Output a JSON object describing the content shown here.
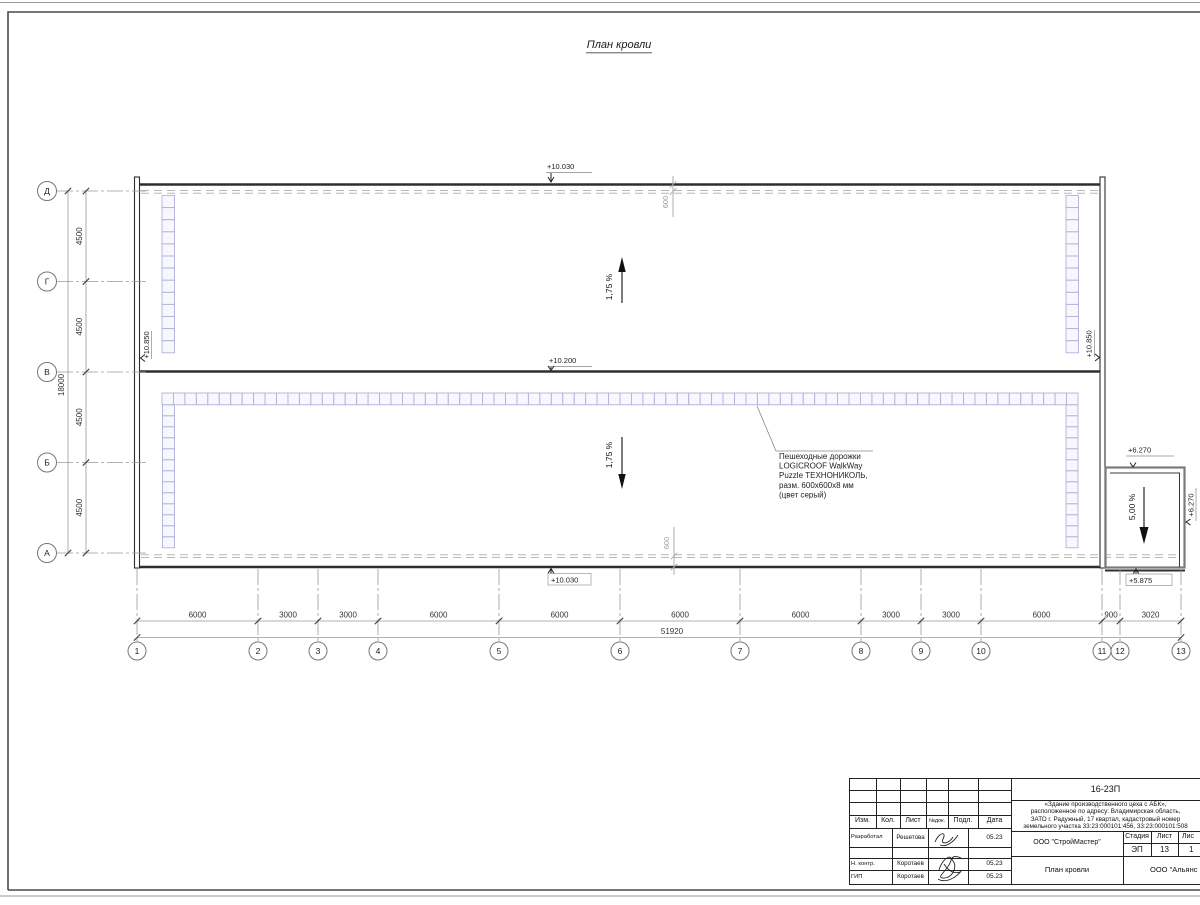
{
  "page": {
    "title": "План кровли"
  },
  "axes": {
    "rows": [
      "Д",
      "Г",
      "В",
      "Б",
      "А"
    ],
    "cols": [
      "1",
      "2",
      "3",
      "4",
      "5",
      "6",
      "7",
      "8",
      "9",
      "10",
      "11",
      "12",
      "13"
    ]
  },
  "dimensions": {
    "row_segments": [
      "4500",
      "4500",
      "4500",
      "4500"
    ],
    "row_total": "18000",
    "col_segments": [
      "6000",
      "3000",
      "3000",
      "6000",
      "6000",
      "6000",
      "6000",
      "3000",
      "3000",
      "6000",
      "900",
      "3020"
    ],
    "col_total": "51920",
    "parapet_top": "600",
    "parapet_bottom": "600"
  },
  "elevations": {
    "roof_top": "+10.030",
    "roof_valley": "+10.200",
    "roof_bottom": "+10.030",
    "parapet_left": "+10.850",
    "parapet_right": "+10.850",
    "annex_top": "+6.270",
    "annex_right": "+6.270",
    "annex_bottom": "+5.875"
  },
  "slopes": {
    "upper": "1,75 %",
    "lower": "1,75 %",
    "annex": "5,00 %"
  },
  "note": {
    "lines": [
      "Пешеходные дорожки",
      "LOGICROOF WalkWay",
      "Puzzle ТЕХНОНИКОЛЬ,",
      "разм. 600x600x8 мм",
      "(цвет серый)"
    ]
  },
  "title_block": {
    "doc_number": "16-23П",
    "description": "«Здание производственного цеха с АБК»,\nрасположенное по адресу: Владимирская область,\nЗАТО г. Радужный, 17 квартал, кадастровый номер\nземельного участка 33:23:000101:456, 33:23:000101:508",
    "cols": {
      "izm": "Изм.",
      "kol": "Кол.",
      "list": "Лист",
      "ndok": "№док.",
      "podl": "Подл.",
      "data": "Дата"
    },
    "rows": [
      {
        "role": "Разработал",
        "name": "Решетова",
        "date": "05.23"
      },
      {
        "role": "Н. контр.",
        "name": "Коротаев",
        "date": "05.23"
      },
      {
        "role": "ГИП",
        "name": "Коротаев",
        "date": "05.23"
      }
    ],
    "design_org": "ООО \"СтройМастер\"",
    "stage_label": "Стадия",
    "sheet_label": "Лист",
    "sheets_label": "Лис",
    "stage": "ЭП",
    "sheet": "13",
    "sheets": "1",
    "drawing_name": "План кровли",
    "contractor": "ООО \"Альянс"
  },
  "colors": {
    "walkway": "#b2b2dc",
    "wall": "#2e2e2e",
    "dim_gray": "#999999",
    "text": "#1c1c1c"
  }
}
